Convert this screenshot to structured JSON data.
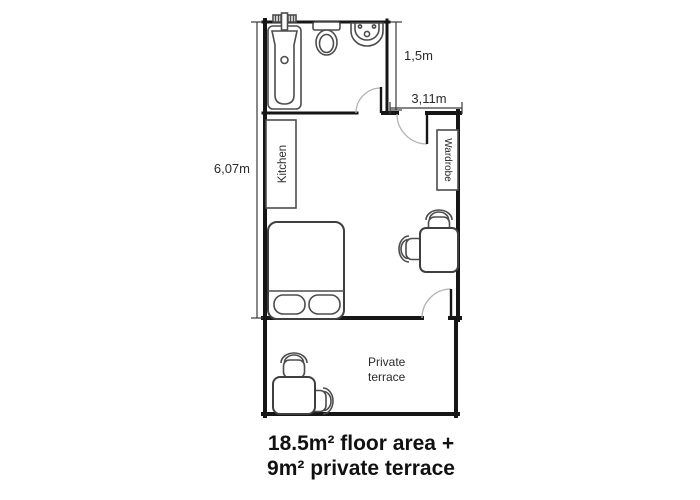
{
  "caption": {
    "line1": "18.5m² floor area +",
    "line2": "9m² private terrace"
  },
  "dimensions": {
    "bathroom_depth": "1,5m",
    "room_width": "3,11m",
    "apartment_length": "6,07m"
  },
  "labels": {
    "kitchen": "Kitchen",
    "wardrobe": "Wardrobe",
    "terrace": {
      "line1": "Private",
      "line2": "terrace"
    }
  },
  "fixtures": [
    "bathtub",
    "toilet",
    "sink",
    "kitchen-counter",
    "wardrobe",
    "double-bed",
    "desk",
    "desk-chair",
    "side-chair",
    "terrace-table",
    "terrace-chair-top",
    "terrace-chair-right"
  ],
  "colors": {
    "wall": "#161616",
    "furniture": "#4d4d4d",
    "door_arc": "#b3b3b3",
    "dimension_line": "#3a3a3a",
    "text": "#2b2b2b",
    "background": "#ffffff"
  }
}
